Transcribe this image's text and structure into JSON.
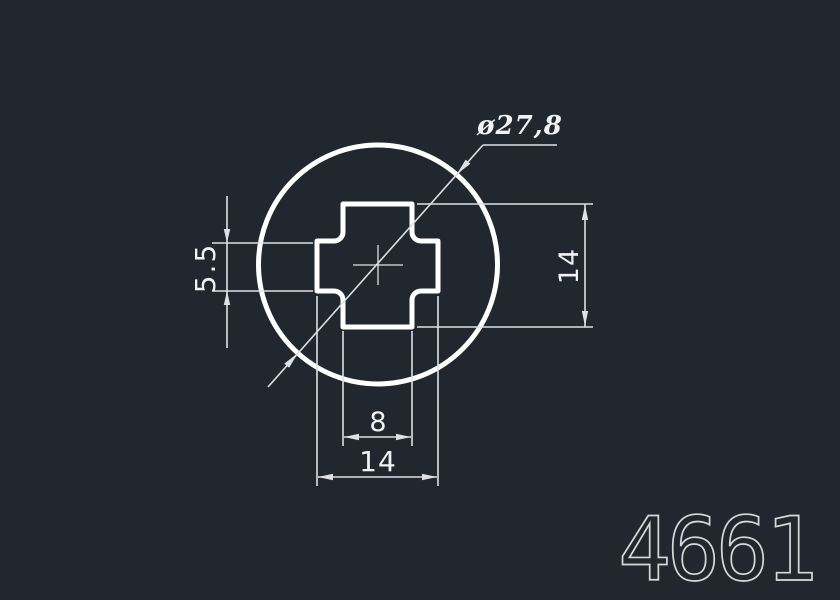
{
  "window": {
    "background": "#20272f"
  },
  "colors": {
    "background": "#20272f",
    "profile_stroke": "#ffffff",
    "dimension_stroke": "#dde1e4",
    "dimension_text": "#f0f2f3",
    "part_number": "#d6dad6"
  },
  "drawing": {
    "part_number": "4661",
    "profile": {
      "description": "circular profile with cross (plus) shaped center cutout and crosshair center mark",
      "circle_diameter": 27.8,
      "cross_overall_width": 14,
      "cross_overall_height": 14,
      "cross_slot_width": 8,
      "cross_slot_height": 5.5
    },
    "dimensions": [
      {
        "id": "diameter",
        "label": "ø27,8",
        "value": 27.8,
        "type": "diameter-leader",
        "location": "top-right"
      },
      {
        "id": "slot-height",
        "label": "5.5",
        "value": 5.5,
        "type": "linear-vertical",
        "location": "left"
      },
      {
        "id": "overall-height",
        "label": "14",
        "value": 14,
        "type": "linear-vertical",
        "location": "right"
      },
      {
        "id": "slot-width",
        "label": "8",
        "value": 8,
        "type": "linear-horizontal",
        "location": "bottom-inner"
      },
      {
        "id": "overall-width",
        "label": "14",
        "value": 14,
        "type": "linear-horizontal",
        "location": "bottom-outer"
      }
    ]
  }
}
